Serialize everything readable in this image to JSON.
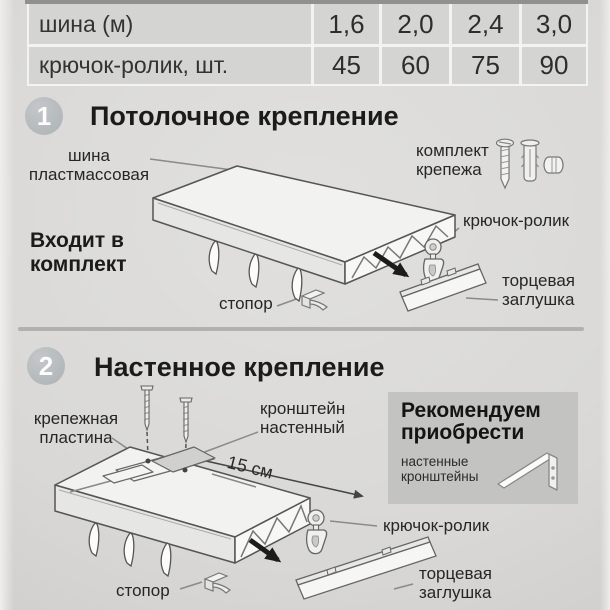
{
  "table": {
    "rows": [
      {
        "label": "шина (м)",
        "values": [
          "1,6",
          "2,0",
          "2,4",
          "3,0"
        ]
      },
      {
        "label": "крючок-ролик, шт.",
        "values": [
          "45",
          "60",
          "75",
          "90"
        ]
      }
    ]
  },
  "section1": {
    "number": "1",
    "title": "Потолочное крепление",
    "included_note": "Входит в комплект",
    "labels": {
      "rail": "шина пластмассовая",
      "kit": "комплект крепежа",
      "hook": "крючок-ролик",
      "stopper": "стопор",
      "endcap": "торцевая заглушка"
    }
  },
  "section2": {
    "number": "2",
    "title": "Настенное крепление",
    "labels": {
      "plate": "крепежная пластина",
      "bracket": "кронштейн настенный",
      "dimension": "15 см",
      "hook": "крючок-ролик",
      "stopper": "стопор",
      "endcap": "торцевая заглушка"
    },
    "recommend": {
      "title": "Рекомендуем приобрести",
      "item": "настенные кронштейны"
    }
  },
  "colors": {
    "background": "#d9d8d6",
    "table_cell": "#d4d5d3",
    "badge": "#b5b9bc",
    "recommend_box": "#c3c3c1",
    "divider": "#b2b1af",
    "text": "#262626"
  }
}
